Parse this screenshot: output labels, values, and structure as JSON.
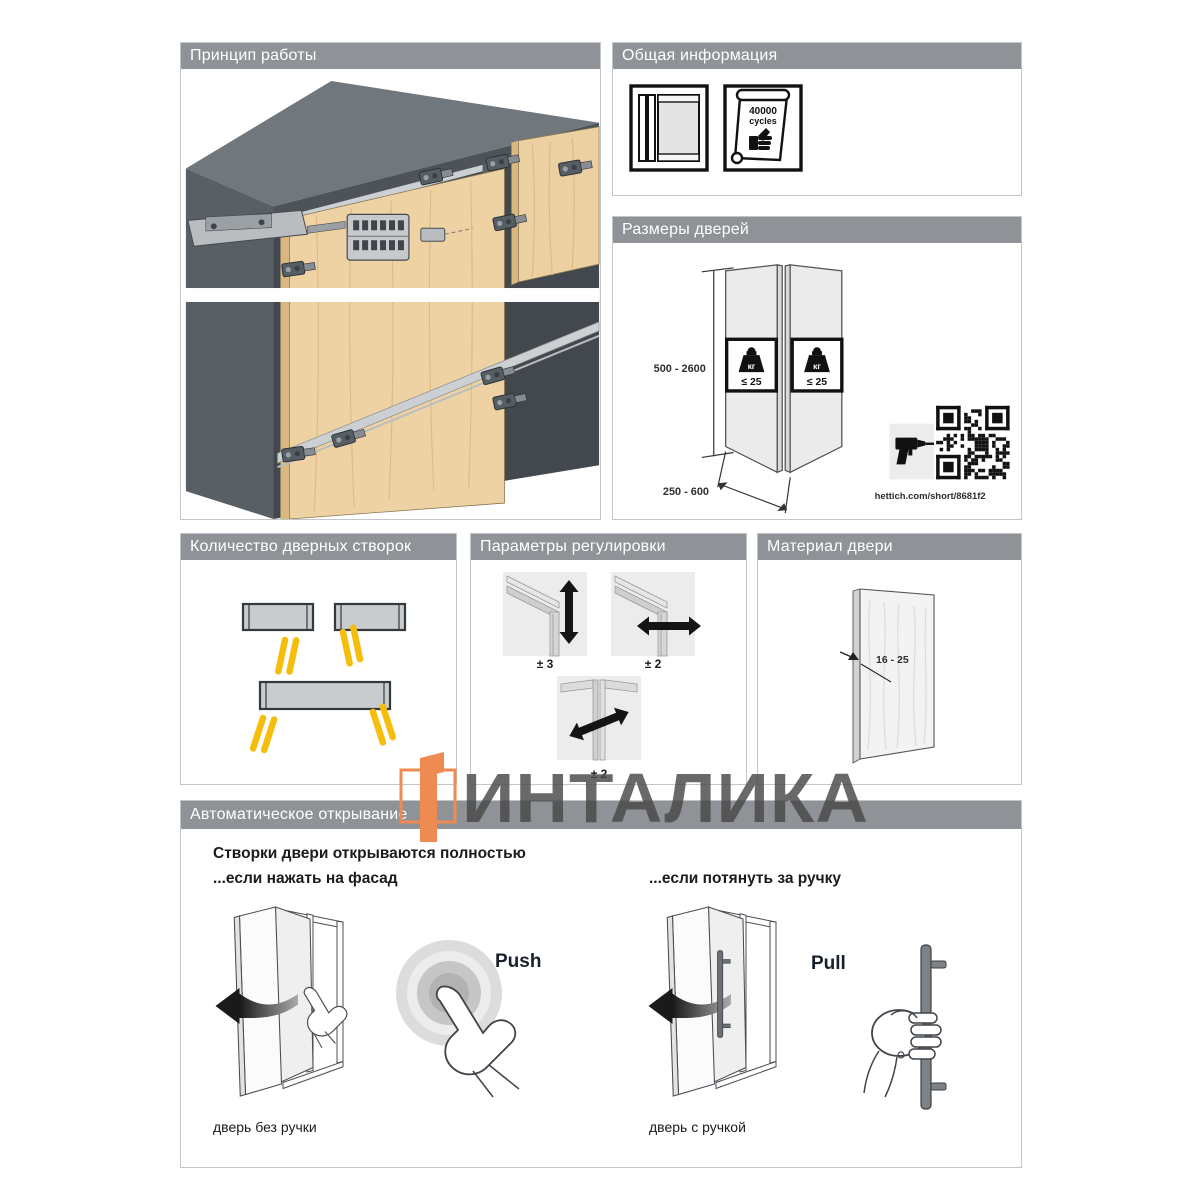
{
  "colors": {
    "header_bar": "#8f9397",
    "accent_orange": "#ef8a52",
    "hinge_yellow": "#f5bd0c",
    "wood": "#ecd0a2",
    "watermark_gray": "#484848"
  },
  "panels": {
    "principle": {
      "title": "Принцип работы"
    },
    "general": {
      "title": "Общая информация",
      "cycles_value": "40000",
      "cycles_unit": "cycles"
    },
    "sizes": {
      "title": "Размеры дверей",
      "height_range": "500 - 2600",
      "width_range": "250 - 600",
      "weight_unit": "кг",
      "weight_limit": "≤ 25",
      "link": "hettich.com/short/8681f2"
    },
    "count": {
      "title": "Количество дверных створок"
    },
    "adjust": {
      "title": "Параметры регулировки",
      "values": [
        "± 3",
        "± 2",
        "± 2"
      ]
    },
    "material": {
      "title": "Материал двери",
      "thickness": "16 - 25"
    },
    "auto": {
      "title": "Автоматическое открывание",
      "intro_line1": "Створки двери открываются полностью",
      "intro_line2": "...если нажать на фасад",
      "pull_intro": "...если потянуть за ручку",
      "push_label": "Push",
      "pull_label": "Pull",
      "caption_no_handle": "дверь без ручки",
      "caption_handle": "дверь с ручкой"
    }
  },
  "watermark": {
    "text": "ИНТАЛИКА"
  }
}
